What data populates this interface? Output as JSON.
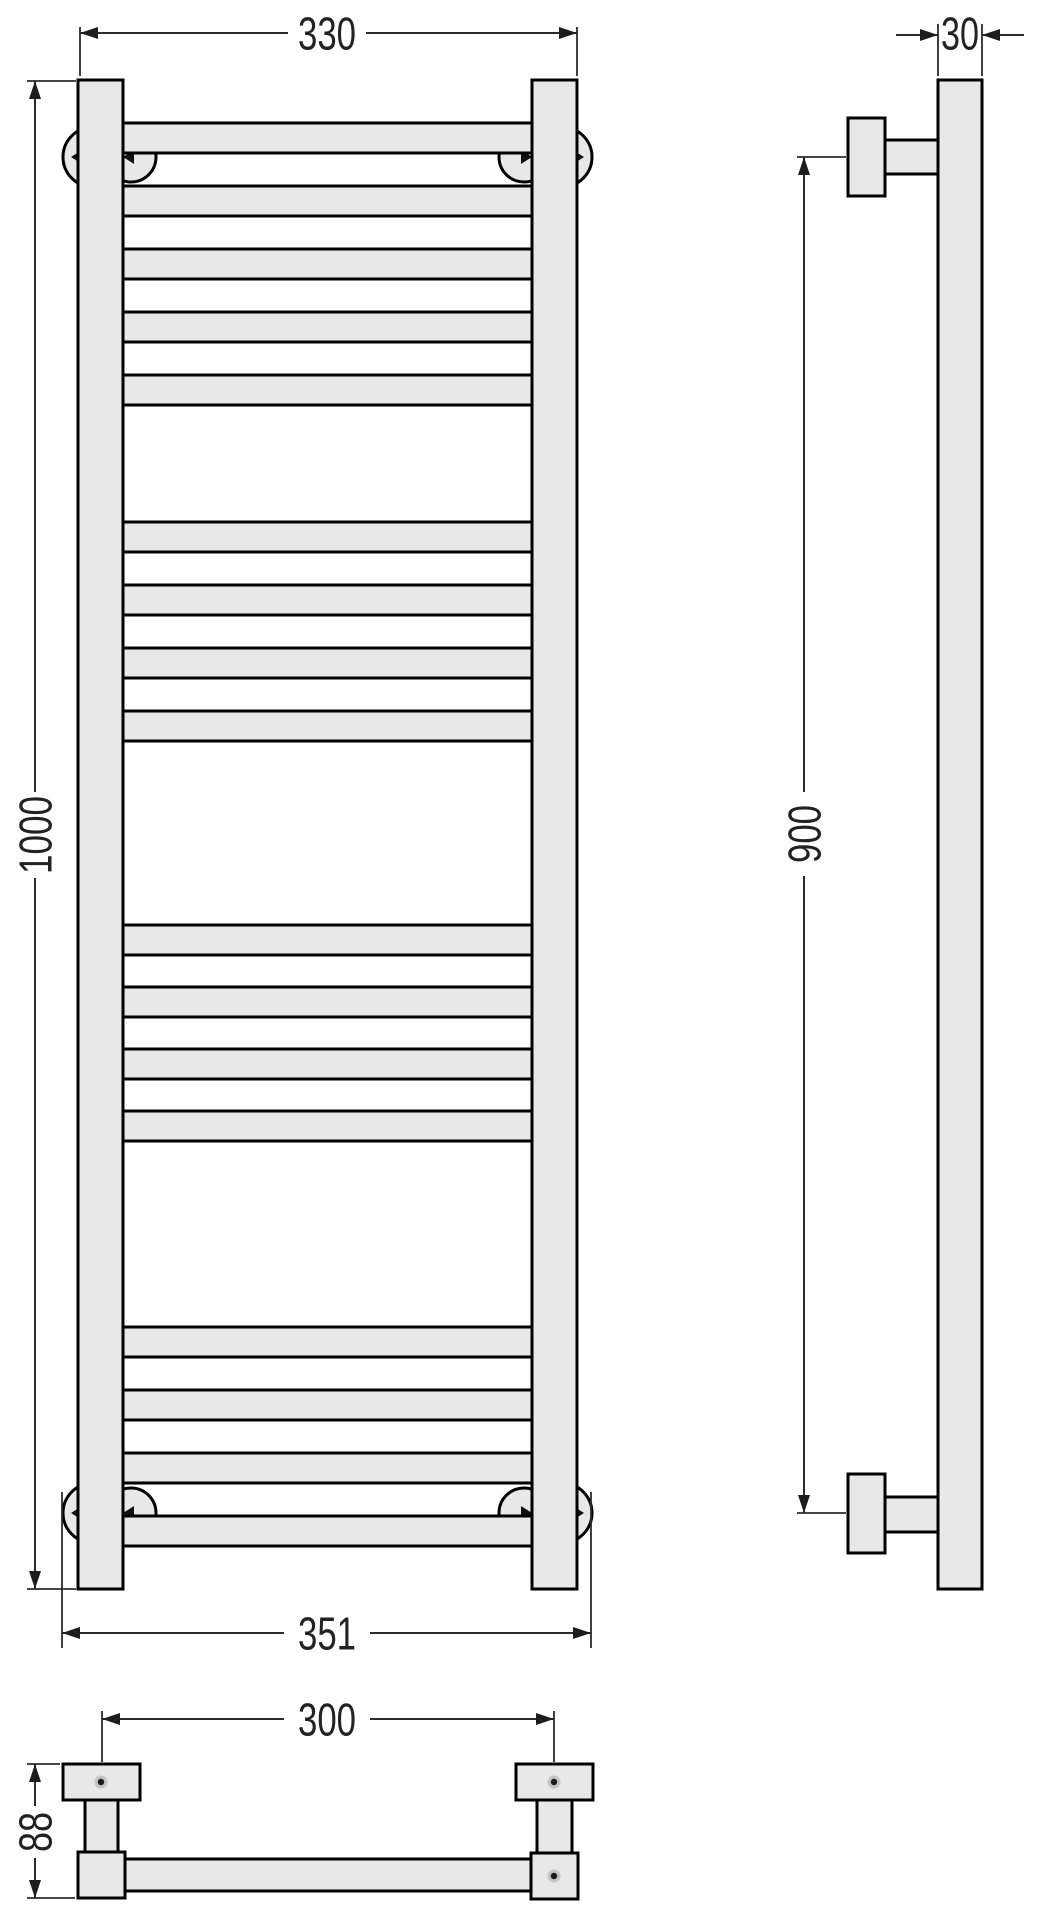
{
  "document": {
    "type": "technical-drawing",
    "background_color": "#ffffff",
    "outline_color": "#000000",
    "part_fill_color": "#e8e8e8",
    "dimension_color": "#2b2b2b"
  },
  "views": {
    "front": {
      "dim_width_top": "330",
      "dim_height": "1000",
      "dim_width_bottom": "351",
      "rung_count": 17,
      "rung_groups": [
        5,
        4,
        4,
        4
      ],
      "post_count": 2,
      "wall_rosette_count": 4
    },
    "side": {
      "dim_tube": "30",
      "dim_mount_height": "900",
      "bracket_count": 2
    },
    "plan": {
      "dim_mount_spacing": "300",
      "dim_depth": "88",
      "screw_dot_count": 3
    }
  }
}
